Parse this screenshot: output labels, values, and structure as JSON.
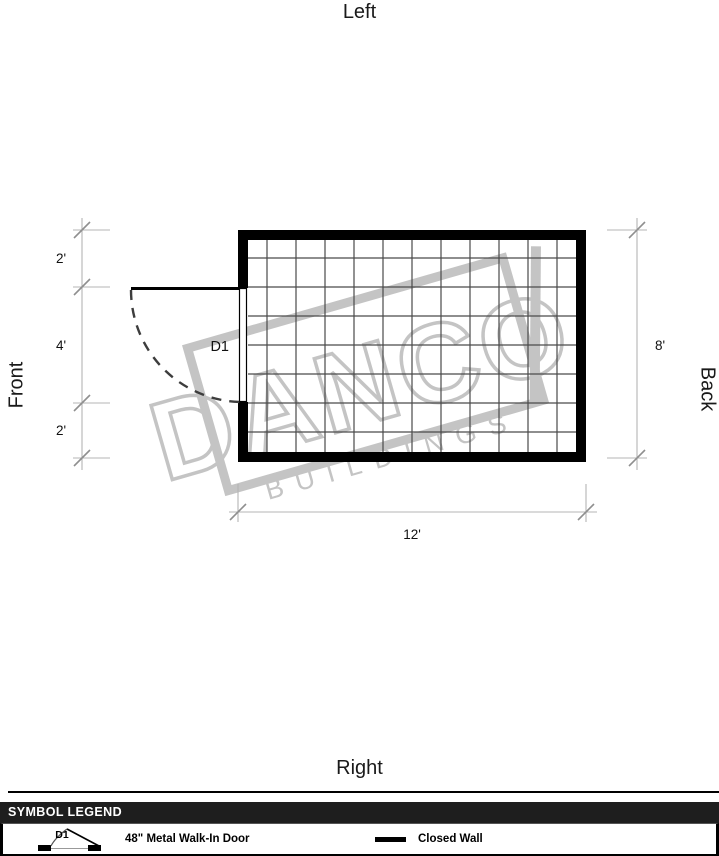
{
  "orientation": {
    "top": "Left",
    "bottom": "Right",
    "left": "Front",
    "right": "Back"
  },
  "dimensions": {
    "left_segments": [
      "2'",
      "4'",
      "2'"
    ],
    "right": "8'",
    "bottom": "12'"
  },
  "plan": {
    "door_label": "D1",
    "building_width_ft": 12,
    "building_depth_ft": 8
  },
  "watermark": {
    "name": "DANCO",
    "sub": "BUILDINGS"
  },
  "legend": {
    "title": "SYMBOL LEGEND",
    "items": [
      {
        "id": "walk-in-door",
        "symbol_label": "D1",
        "label": "48\" Metal Walk-In Door"
      },
      {
        "id": "closed-wall",
        "label": "Closed Wall"
      }
    ]
  },
  "colors": {
    "wall": "#000000",
    "grid": "#4a4a4a",
    "dimension_line": "#b4b4b4",
    "dimension_tick": "#8f8f8f",
    "watermark": "#c4c4c4",
    "legend_header_bg": "#1e1e1e",
    "legend_header_text": "#ffffff"
  }
}
